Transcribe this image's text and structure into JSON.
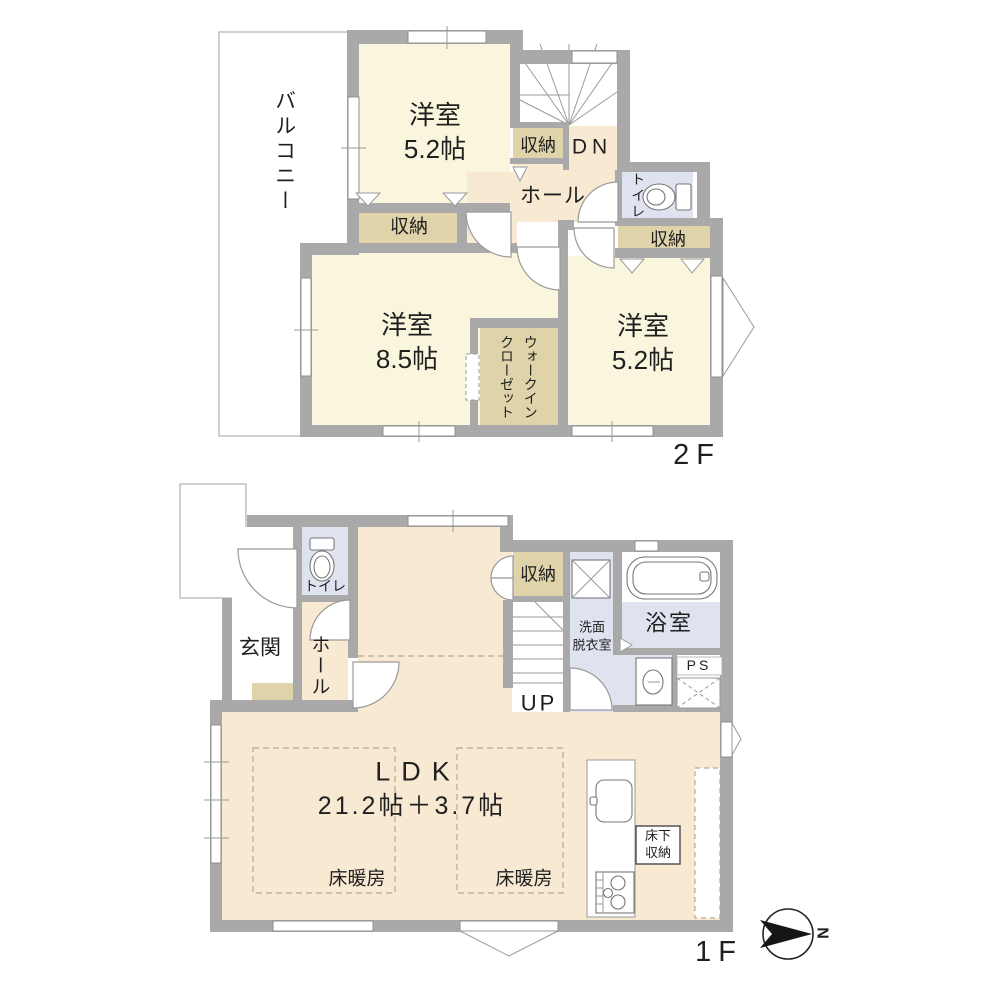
{
  "floor2": {
    "label": "2F",
    "balcony": "バルコニー",
    "room_a": {
      "name": "洋室",
      "size": "5.2帖"
    },
    "room_b": {
      "name": "洋室",
      "size": "8.5帖"
    },
    "room_c": {
      "name": "洋室",
      "size": "5.2帖"
    },
    "closet_a": "収納",
    "closet_b": "収納",
    "closet_c": "収納",
    "stairs_down": "DN",
    "hall": "ホール",
    "toilet": "トイレ",
    "wic_line1": "ウォークイン",
    "wic_line2": "クローゼット"
  },
  "floor1": {
    "label": "1F",
    "entrance": "玄関",
    "toilet": "トイレ",
    "hall": "ホール",
    "closet": "収納",
    "stairs_up": "UP",
    "washroom_line1": "洗面",
    "washroom_line2": "脱衣室",
    "bathroom": "浴室",
    "pipe_space": "PS",
    "ldk_title": "LDK",
    "ldk_size": "21.2帖＋3.7帖",
    "floor_heating_1": "床暖房",
    "floor_heating_2": "床暖房",
    "underfloor_line1": "床下",
    "underfloor_line2": "収納"
  },
  "compass": {
    "north": "N"
  },
  "colors": {
    "wall": "#a9a9a9",
    "room_cream": "#faf6de",
    "room_beige": "#f8e9d3",
    "closet_tan": "#ded3a9",
    "wet_blue": "#dfe3ef",
    "outline_white": "#ffffff"
  }
}
